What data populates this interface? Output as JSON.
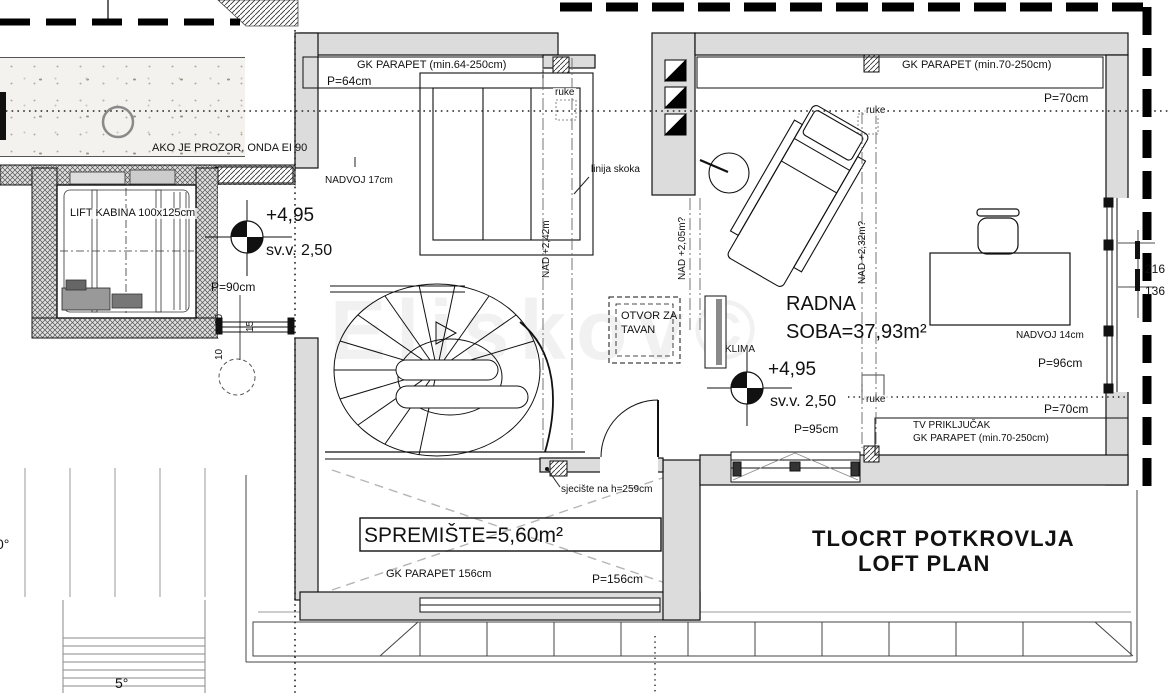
{
  "title": {
    "line1": "TLOCRT POTKROVLJA",
    "line2": "LOFT PLAN"
  },
  "watermark": "Eliskov©",
  "colors": {
    "wall_fill": "#dcdcdc",
    "line": "#111111",
    "accent_black": "#000000"
  },
  "rooms": {
    "radna_soba": {
      "name_line1": "RADNA",
      "name_line2": "SOBA=37,93m²",
      "level": "+4,95",
      "clear_height": "sv.v.  2,50"
    },
    "spremiste": {
      "name": "SPREMIŠTE=5,60m²"
    },
    "lift": {
      "label": "LIFT KABINA 100x125cm"
    }
  },
  "labels": {
    "gk_parapet_64": "GK PARAPET (min.64-250cm)",
    "p64": "P=64cm",
    "ruke": "ruke",
    "nadvoj17": "NADVOJ 17cm",
    "ako_prozor": "AKO JE PROZOR, ONDA EI 90",
    "lift_kabina": "LIFT KABINA 100x125cm",
    "level_495": "+4,95",
    "svv_250": "sv.v.  2,50",
    "p90": "P=90cm",
    "dim_90": "90",
    "dim_15": "15",
    "dim_10": "10",
    "linija_skoka": "linija skoka",
    "nad_242": "NAD +2,42m",
    "nad_205": "NAD +2,05m?",
    "nad_232": "NAD +2,32m?",
    "otvor_line1": "OTVOR ZA",
    "otvor_line2": "TAVAN",
    "klima": "KLIMA",
    "radna_line1": "RADNA",
    "radna_line2": "SOBA=37,93m²",
    "p95": "P=95cm",
    "tv_prikljucak": "TV PRIKLJUČAK",
    "gk_parapet_70": "GK PARAPET (min.70-250cm)",
    "p70": "P=70cm",
    "nadvoj14": "NADVOJ 14cm",
    "p96": "P=96cm",
    "dim_216": "216",
    "dim_136": "136",
    "sjeciste": "sjecište na h=259cm",
    "spremiste": "SPREMIŠTE=5,60m²",
    "gk_parapet_156": "GK PARAPET 156cm",
    "p156": "P=156cm",
    "deg0": "0°",
    "deg5": "5°"
  }
}
